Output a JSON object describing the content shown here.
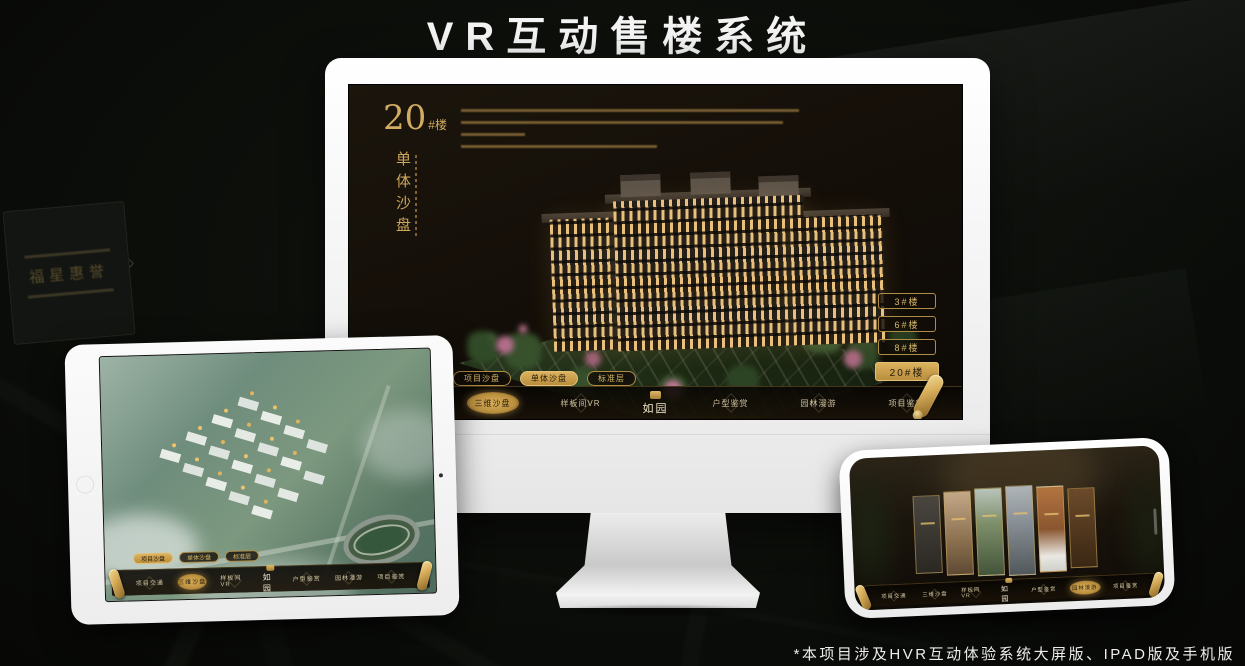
{
  "page": {
    "title": "VR互动售楼系统",
    "footnote": "*本项目涉及HVR互动体验系统大屏版、IPAD版及手机版"
  },
  "colors": {
    "gold": "#c9a050",
    "gold_text": "#d8b868",
    "screen_bg": "#16110a",
    "page_bg": "#0b0d0a"
  },
  "background": {
    "plaque_title": "福星惠誉"
  },
  "monitor": {
    "headline": {
      "number": "20",
      "unit": "#楼",
      "vertical_title": "单体沙盘"
    },
    "floor_buttons": [
      {
        "label": "3#楼",
        "active": false
      },
      {
        "label": "6#楼",
        "active": false
      },
      {
        "label": "8#楼",
        "active": false
      },
      {
        "label": "20#楼",
        "active": true
      }
    ],
    "tabs": [
      {
        "label": "项目沙盘",
        "active": false
      },
      {
        "label": "单体沙盘",
        "active": true
      },
      {
        "label": "标准层",
        "active": false
      }
    ],
    "nav": {
      "left_items": [
        {
          "label": "项目交通",
          "active": false
        },
        {
          "label": "三维沙盘",
          "active": true
        },
        {
          "label": "样板间VR",
          "active": false
        }
      ],
      "logo": "如园",
      "right_items": [
        {
          "label": "户型鉴赏",
          "active": false
        },
        {
          "label": "园林漫游",
          "active": false
        },
        {
          "label": "项目鉴赏",
          "active": false
        }
      ]
    }
  },
  "tablet": {
    "tabs": [
      {
        "label": "项目沙盘",
        "active": true
      },
      {
        "label": "单体沙盘",
        "active": false
      },
      {
        "label": "标准层",
        "active": false
      }
    ],
    "nav": {
      "left_items": [
        {
          "label": "项目交通",
          "active": false
        },
        {
          "label": "三维沙盘",
          "active": true
        },
        {
          "label": "样板间VR",
          "active": false
        }
      ],
      "logo": "如园",
      "right_items": [
        {
          "label": "户型鉴赏",
          "active": false
        },
        {
          "label": "园林漫游",
          "active": false
        },
        {
          "label": "项目鉴赏",
          "active": false
        }
      ]
    }
  },
  "phone": {
    "nav": {
      "left_items": [
        {
          "label": "项目交通",
          "active": false
        },
        {
          "label": "三维沙盘",
          "active": false
        },
        {
          "label": "样板间VR",
          "active": false
        }
      ],
      "logo": "如园",
      "right_items": [
        {
          "label": "户型鉴赏",
          "active": false
        },
        {
          "label": "园林漫游",
          "active": true
        },
        {
          "label": "项目鉴赏",
          "active": false
        }
      ]
    }
  }
}
